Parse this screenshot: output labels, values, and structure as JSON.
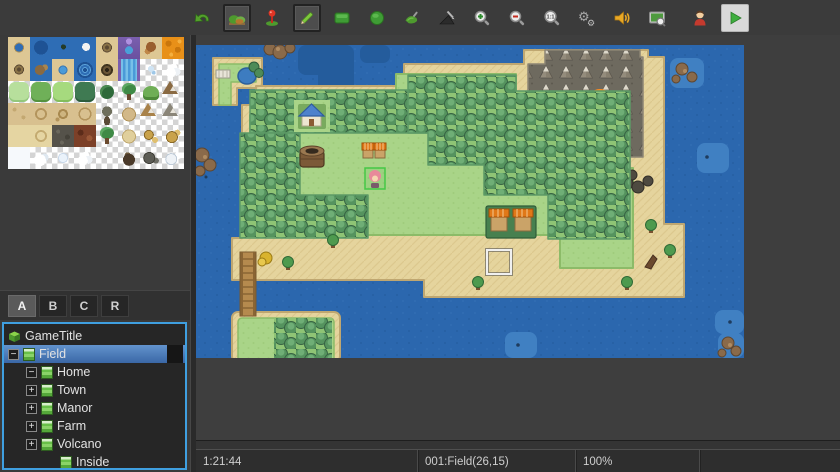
{
  "toolbar": {
    "buttons": [
      {
        "icon": "undo-icon",
        "selected": false
      },
      {
        "icon": "map-mode-icon",
        "selected": true
      },
      {
        "icon": "event-mode-icon",
        "selected": false
      },
      {
        "icon": "pencil-icon",
        "selected": true
      },
      {
        "icon": "rectangle-icon",
        "selected": false
      },
      {
        "icon": "ellipse-icon",
        "selected": false
      },
      {
        "icon": "flood-fill-icon",
        "selected": false
      },
      {
        "icon": "shadow-pen-icon",
        "selected": false
      },
      {
        "icon": "zoom-in-icon",
        "selected": false
      },
      {
        "icon": "zoom-out-icon",
        "selected": false
      },
      {
        "icon": "actual-size-icon",
        "selected": false
      },
      {
        "icon": "gears-icon",
        "selected": false
      },
      {
        "icon": "sound-icon",
        "selected": false
      },
      {
        "icon": "screen-search-icon",
        "selected": false
      },
      {
        "icon": "character-icon",
        "selected": false
      },
      {
        "icon": "play-icon",
        "selected": false
      }
    ]
  },
  "palette": {
    "tabs": [
      {
        "label": "A",
        "selected": true
      },
      {
        "label": "B",
        "selected": false
      },
      {
        "label": "C",
        "selected": false
      },
      {
        "label": "R",
        "selected": false
      }
    ],
    "tiles": [
      "sand-hole",
      "water-deep",
      "water-boat",
      "water-ship",
      "sand-swirl",
      "waterfall-top",
      "sand-brush",
      "lava",
      "sand-swirl",
      "water-rocks",
      "sand-pond",
      "whirlpool",
      "sand-vortex",
      "waterfall",
      "sparkle",
      "cloud",
      "grass-light",
      "grass-mid",
      "grass-bright",
      "grass-dark",
      "bush",
      "tree",
      "hill",
      "mountain-brown",
      "dirt-plain",
      "dirt-ring1",
      "dirt-ring2",
      "dirt-ring3",
      "dead-tree",
      "dirt-mound",
      "mountain-dirt",
      "mountain-rock",
      "sand-plain",
      "sand-ring",
      "gravel",
      "lava-rock",
      "tree-green",
      "sand-mound",
      "rocks-gold",
      "rocks-gold2",
      "snow-plain",
      "snow-pile",
      "ice-shard",
      "snow-cloud",
      "empty",
      "rock-dark",
      "rocks-dark",
      "snow-rocks"
    ]
  },
  "tree": {
    "items": [
      {
        "label": "GameTitle",
        "icon": "game-cube-icon",
        "expander": "",
        "level": 0,
        "selected": false
      },
      {
        "label": "Field",
        "icon": "map-icon",
        "expander": "−",
        "level": 0,
        "selected": true
      },
      {
        "label": "Home",
        "icon": "map-icon",
        "expander": "−",
        "level": 1,
        "selected": false
      },
      {
        "label": "Town",
        "icon": "map-icon",
        "expander": "+",
        "level": 1,
        "selected": false
      },
      {
        "label": "Manor",
        "icon": "map-icon",
        "expander": "+",
        "level": 1,
        "selected": false
      },
      {
        "label": "Farm",
        "icon": "map-icon",
        "expander": "+",
        "level": 1,
        "selected": false
      },
      {
        "label": "Volcano",
        "icon": "map-icon",
        "expander": "+",
        "level": 1,
        "selected": false
      },
      {
        "label": "Inside",
        "icon": "map-icon",
        "expander": "",
        "level": 2,
        "selected": false
      }
    ]
  },
  "statusbar": {
    "time": "1:21:44",
    "map_info": "001:Field(26,15)",
    "zoom": "100%"
  },
  "colors": {
    "accent_blue": "#3f9fe0",
    "selection_blue": "#4a7fc1",
    "water": "#2b67ae",
    "grass": "#a9d488",
    "sand": "#e5d49d",
    "forest": "#55935e",
    "rock": "#6e6a5f",
    "lava": "#ff8c1e"
  }
}
